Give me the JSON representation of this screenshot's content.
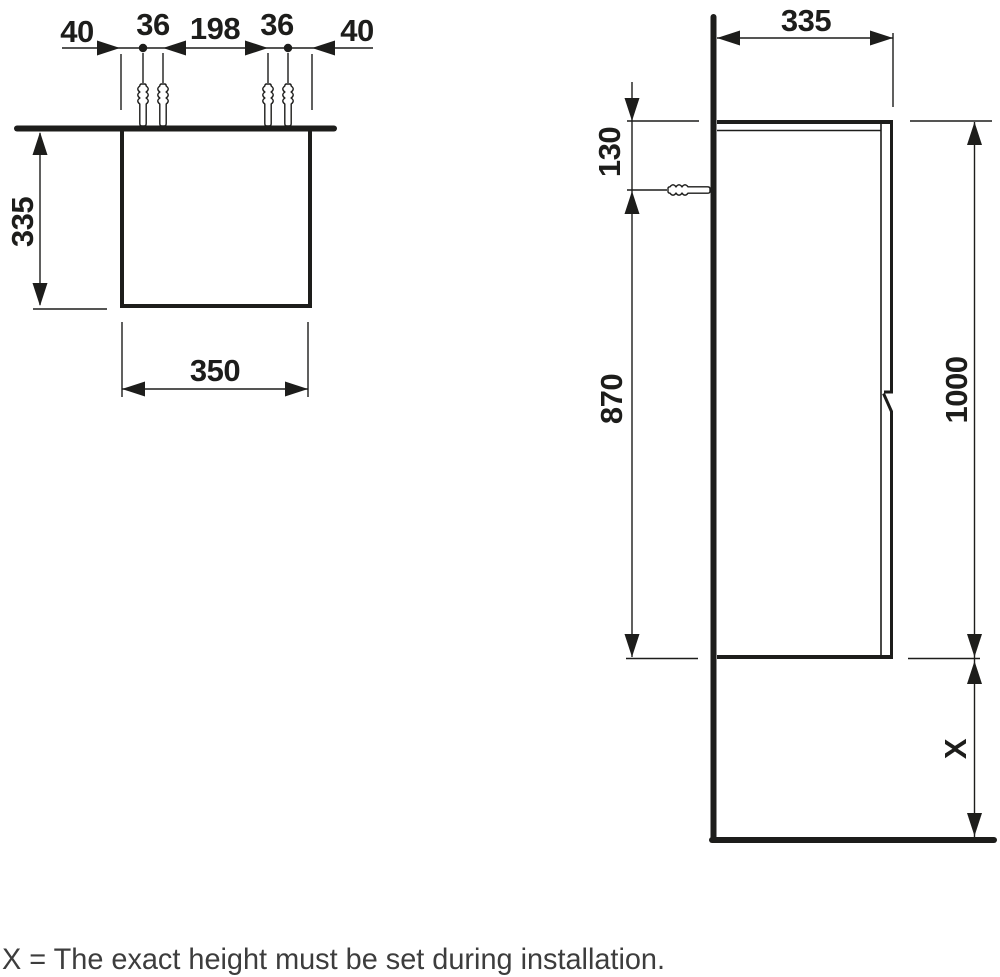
{
  "drawing": {
    "type": "technical-installation-drawing",
    "subject": "wall-mounted tall cabinet with fixing plugs",
    "views": {
      "plan": {
        "dim_edge_left": "40",
        "dim_plug_pair_left": "36",
        "dim_between_pairs": "198",
        "dim_plug_pair_right": "36",
        "dim_edge_right": "40",
        "dim_depth": "335",
        "dim_width": "350"
      },
      "side": {
        "dim_depth": "335",
        "dim_top_to_fixing": "130",
        "dim_fixing_to_bottom": "870",
        "dim_height": "1000",
        "dim_floor_clearance": "X"
      }
    },
    "caption": "X = The exact height must be set during installation.",
    "colors": {
      "line": "#1d1d1b",
      "caption_text": "#3d3d3d",
      "background": "#ffffff"
    }
  }
}
